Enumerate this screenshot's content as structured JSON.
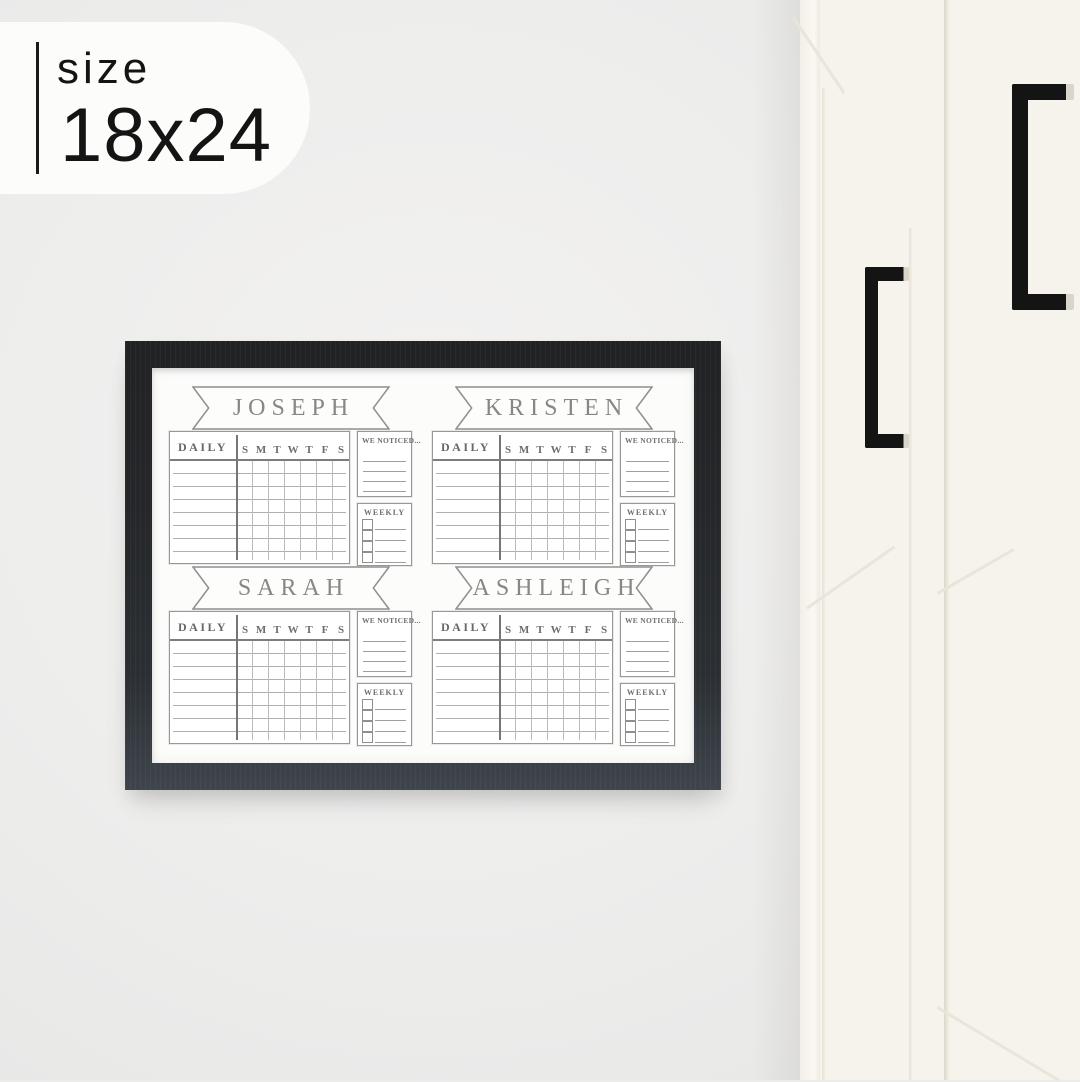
{
  "badge": {
    "label": "size",
    "value": "18x24"
  },
  "board": {
    "people": [
      {
        "name": "JOSEPH"
      },
      {
        "name": "KRISTEN"
      },
      {
        "name": "SARAH"
      },
      {
        "name": "ASHLEIGH"
      }
    ],
    "labels": {
      "daily": "DAILY",
      "we_noticed": "WE NOTICED...",
      "weekly": "WEEKLY"
    },
    "day_letters": [
      "S",
      "M",
      "T",
      "W",
      "T",
      "F",
      "S"
    ],
    "colors": {
      "frame": "#26282b",
      "ink": "#8d8d8d",
      "board_white": "#fcfcfb"
    }
  },
  "scene": {
    "colors": {
      "wall": "#ececeb",
      "cabinet": "#f6f3ec",
      "handle": "#141414"
    }
  }
}
